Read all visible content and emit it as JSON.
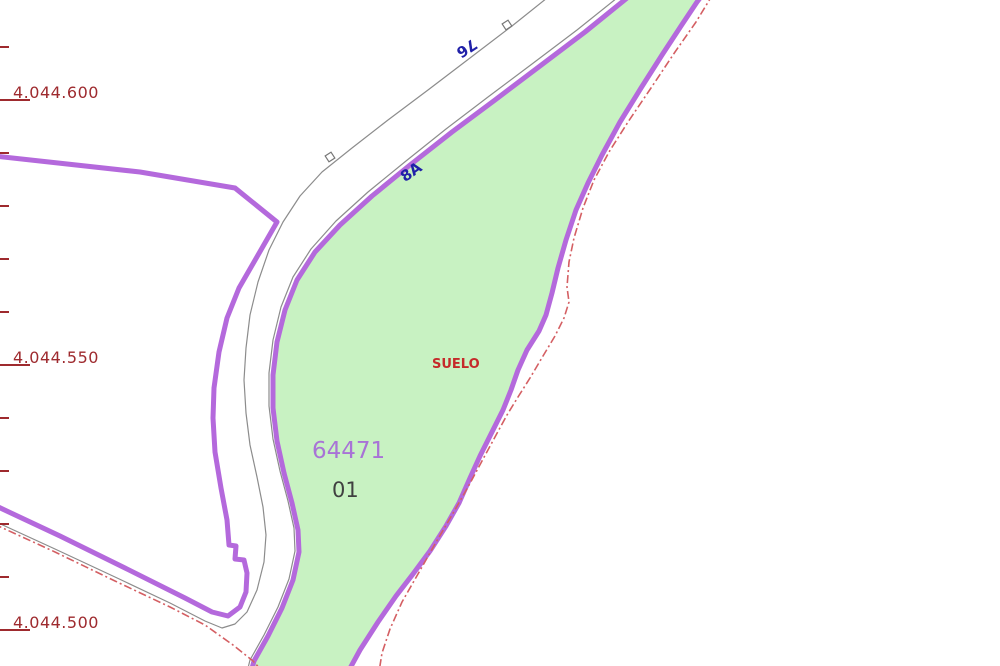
{
  "map": {
    "title": "cadastral-parcel-map",
    "background_color": "#ffffff",
    "parcel": {
      "id_label": "64471",
      "sub_label": "01",
      "land_use_label": "SUELO",
      "fill_color": "#c8f2c2",
      "border_color": "#b469dc"
    },
    "road_labels": [
      {
        "text": "8A",
        "color": "#2020a8",
        "rotation_deg": -35
      },
      {
        "text": "76",
        "color": "#2020a8",
        "rotation_deg": 147
      }
    ],
    "grid": {
      "color": "#9e2a2e",
      "labels": [
        {
          "text": "4.044.600"
        },
        {
          "text": "4.044.550"
        },
        {
          "text": "4.044.500"
        }
      ]
    },
    "line_colors": {
      "cadastral_boundary": "#b469dc",
      "road_edge": "#8c8c8c",
      "limit_dashed": "#d45f63"
    },
    "markers": [
      {
        "name": "km-marker",
        "shape": "small-square"
      },
      {
        "name": "km-marker",
        "shape": "small-square"
      }
    ]
  }
}
